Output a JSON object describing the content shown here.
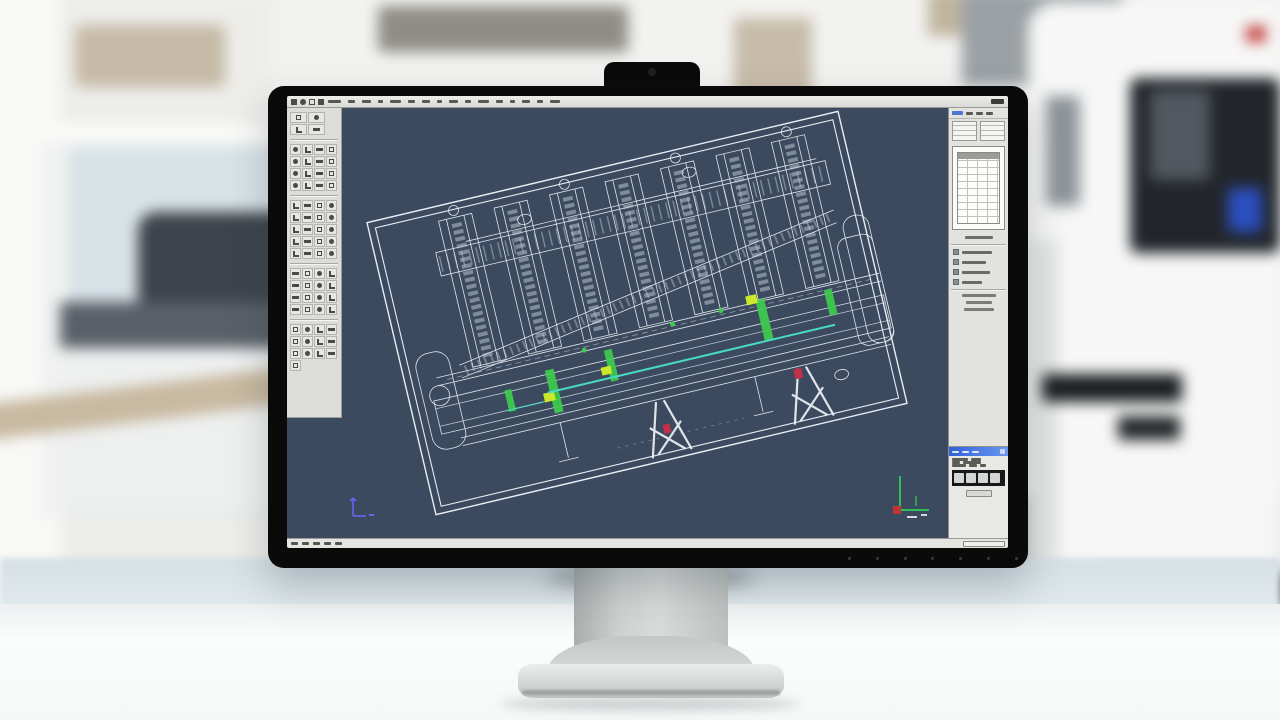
{
  "app": {
    "kind": "cad-workstation",
    "note": "photo of desktop monitor running CAD software in a lab office"
  },
  "palette": {
    "canvas_bg": "#3b4a5e",
    "wireframe": "#e9eef4",
    "wireframe_dim": "#ccd6e0",
    "accent_green": "#3ecb4e",
    "accent_yellow": "#cbe82a",
    "accent_cyan": "#49d8c8",
    "accent_red": "#c3304a",
    "ucs_blue": "#6b63f2",
    "axis_green": "#2ebf57",
    "axis_red": "#c23333",
    "panel_bg": "#dcdcd9",
    "dialog_titlebar": "#2f62d8",
    "bezel": "#0a0a0b"
  },
  "menubar": {
    "left_icon_glyphs": [
      "app-icon",
      "save-icon",
      "print-icon",
      "undo-icon"
    ],
    "item_mark_widths": [
      13,
      7,
      9,
      5,
      11,
      7,
      8,
      5,
      9,
      6,
      11,
      7,
      5,
      8,
      6,
      10
    ],
    "right_mark": "window-controls"
  },
  "left_toolbar": {
    "group_icon_counts": [
      4,
      16,
      20,
      16,
      13
    ],
    "columns": 4
  },
  "right_panel": {
    "strip_marks": 3,
    "thumbnails": 2,
    "preview": "parts-table-sheet",
    "section_line_widths": [
      30,
      24,
      28,
      20
    ],
    "lower_line_widths": [
      34,
      26,
      30
    ],
    "dialog": {
      "title_marks": 3,
      "filmstrip_blobs": 4,
      "row_mark_widths": [
        [
          16,
          10
        ],
        [
          8,
          18
        ],
        [
          14,
          8,
          6
        ]
      ]
    }
  },
  "statusbar": {
    "left_marks": 5
  },
  "bezel": {
    "control_dots": 7
  },
  "drawing": {
    "rotation_deg": -13.3,
    "frame": {
      "x": 108,
      "y": 55,
      "w": 484,
      "h": 300,
      "inset": 7
    },
    "tower_xs": [
      178,
      235,
      292,
      349,
      406,
      463,
      520
    ],
    "tower_w": 34,
    "green_bars": [
      [
        247,
        240,
        9,
        44
      ],
      [
        309,
        234,
        8,
        32
      ],
      [
        468,
        220,
        9,
        42
      ],
      [
        537,
        226,
        8,
        26
      ],
      [
        203,
        250,
        7,
        22
      ]
    ],
    "green_dots": [
      [
        290,
        229
      ],
      [
        382,
        224
      ],
      [
        432,
        222
      ]
    ],
    "yellow_marks": [
      [
        240,
        262,
        11,
        9
      ],
      [
        302,
        250,
        10,
        8
      ],
      [
        459,
        214,
        11,
        9
      ]
    ],
    "red_marks": [
      [
        489,
        296,
        8,
        10
      ],
      [
        349,
        320,
        7,
        9
      ]
    ],
    "cyan_line": [
      245,
      262,
      540,
      262
    ],
    "xleg_xs": [
      352,
      498
    ]
  }
}
